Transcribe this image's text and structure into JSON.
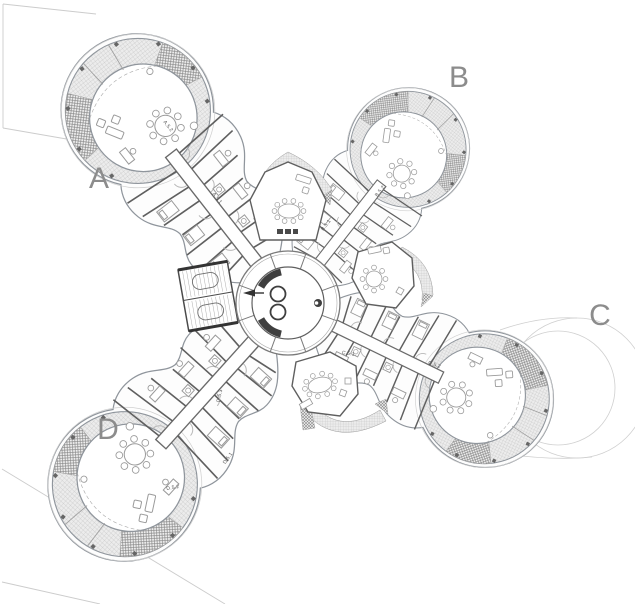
{
  "drawing": {
    "description": "architectural floor plan, four-wing pinwheel tower level 5",
    "wing_labels": {
      "a": "A",
      "b": "B",
      "c": "C",
      "d": "D"
    },
    "unit_labels": {
      "a51": "A.5.1",
      "a52": "A.5.2",
      "b51": "B.5.1",
      "b52": "B.5.2",
      "c51": "C.5.1.",
      "c52": "C.5.2",
      "d51": "D.5.1",
      "d52": "D.5.2",
      "d53": "D.5.3"
    },
    "colors": {
      "background": "#ffffff",
      "wall": "#5f5f5f",
      "outline": "#8f959c",
      "furniture": "#9a9a9a",
      "label": "#8c8c8c",
      "faint_boundary": "#cccccc",
      "hatch_light": "#bfbfbf",
      "hatch_dark": "#878787"
    }
  }
}
